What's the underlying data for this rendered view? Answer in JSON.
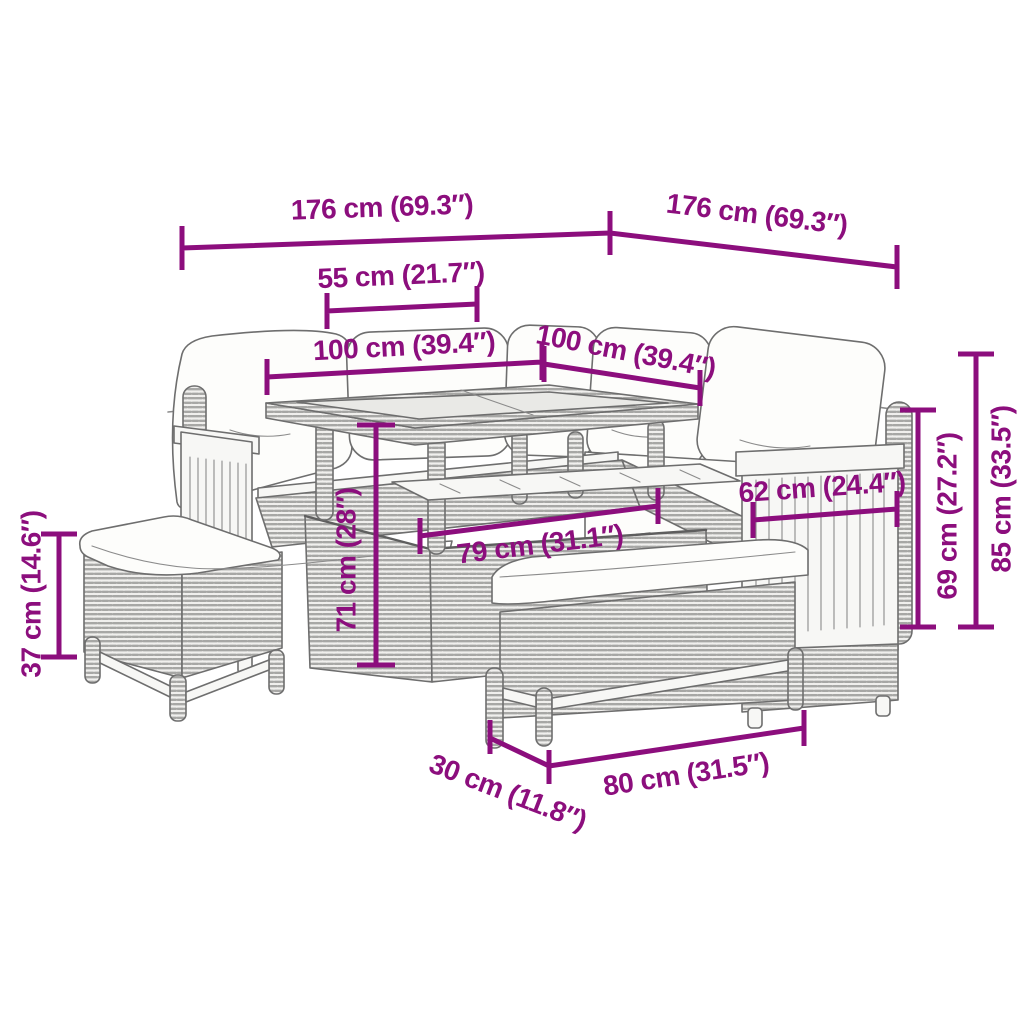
{
  "diagram": {
    "kind": "product dimension diagram",
    "subject": "poly rattan garden lounge set: L-shaped corner sofa with cushions, storage dining table with glass top, two benches",
    "background": "#ffffff"
  },
  "colors": {
    "dimension_annotation": "#8C0E7D",
    "furniture_outline": "#6E6E6E",
    "rattan_weave": "#A7A7A5",
    "cushion_fill": "#FDFDFB",
    "glass_fill": "#E9E9E6"
  },
  "dimensions": [
    {
      "id": "sofa-section-left-width",
      "label": "176 cm (69.3″)"
    },
    {
      "id": "sofa-section-right-width",
      "label": "176 cm (69.3″)"
    },
    {
      "id": "table-top-depth",
      "label": "55 cm (21.7″)"
    },
    {
      "id": "seat-width-left",
      "label": "100 cm (39.4″)"
    },
    {
      "id": "seat-width-right",
      "label": "100 cm (39.4″)"
    },
    {
      "id": "table-height",
      "label": "71 cm (28″)"
    },
    {
      "id": "table-length",
      "label": "79 cm (31.1″)"
    },
    {
      "id": "armrest-panel-width",
      "label": "62 cm (24.4″)"
    },
    {
      "id": "backrest-height",
      "label": "69 cm (27.2″)"
    },
    {
      "id": "sofa-total-height",
      "label": "85 cm (33.5″)"
    },
    {
      "id": "bench-height",
      "label": "37 cm (14.6″)"
    },
    {
      "id": "bench-depth",
      "label": "30 cm (11.8″)"
    },
    {
      "id": "bench-width",
      "label": "80 cm (31.5″)"
    }
  ]
}
